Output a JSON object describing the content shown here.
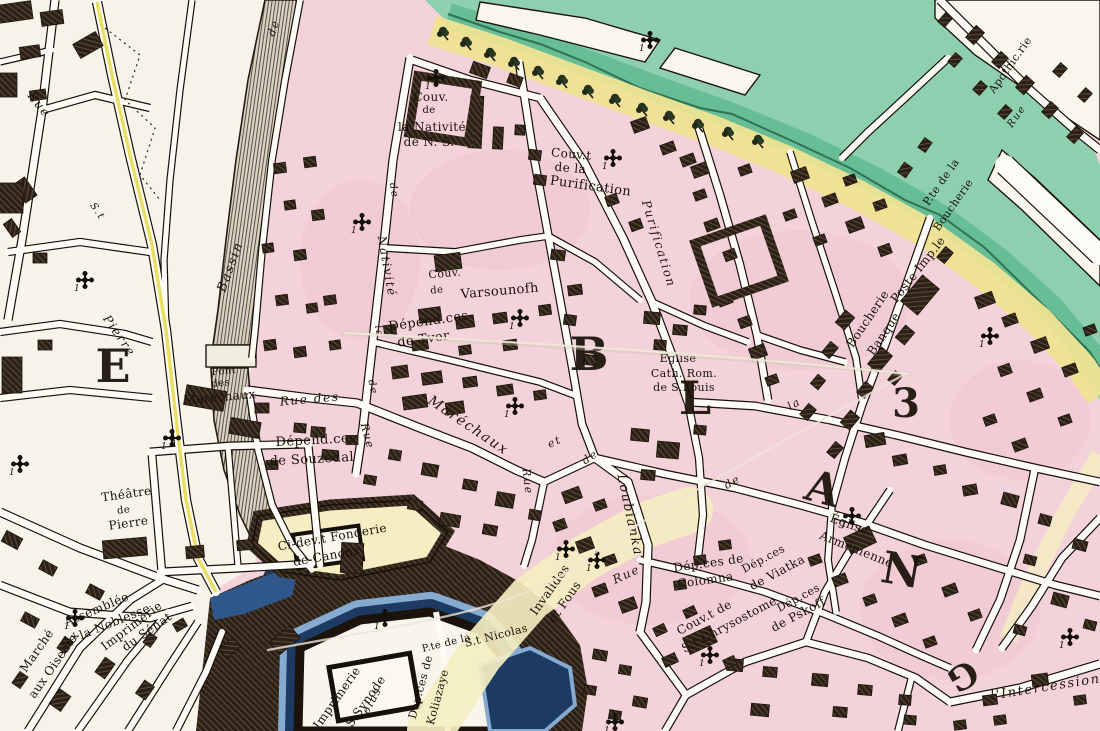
{
  "map": {
    "type": "engraved-city-plan",
    "palette": {
      "paper": "#f7f3ea",
      "street_white": "#fdfbf5",
      "block_pink": "#f4d2d9",
      "pink_mottle": "#ecc2cc",
      "river_green": "#8ecfae",
      "river_green_deep": "#66bd96",
      "river_line": "#2e7354",
      "bank_yellow": "#eee394",
      "pale_yellow": "#f4eec2",
      "road_yellow": "#e9de63",
      "building_dark": "#2c2117",
      "hatch_light": "#5d4d3a",
      "channel_gray": "#ddd6c8",
      "moat_navy": "#1d3a63",
      "moat_blue": "#3a6aa0",
      "moat_light": "#86abd1",
      "ink": "#17100a"
    },
    "icons": {
      "church_cross": "cross-pattee church marker",
      "tree": "riverbank tree glyph",
      "cross_numeral": "1"
    },
    "labels": [
      {
        "t": "Couv.",
        "x": 431,
        "y": 101,
        "r": 0,
        "s": 12,
        "k": "place"
      },
      {
        "t": "de",
        "x": 429,
        "y": 113,
        "r": 0,
        "s": 10,
        "k": "place"
      },
      {
        "t": "la Nativité",
        "x": 432,
        "y": 131,
        "r": 0,
        "s": 12,
        "k": "place"
      },
      {
        "t": "de N. S.",
        "x": 429,
        "y": 146,
        "r": 0,
        "s": 12,
        "k": "place"
      },
      {
        "t": "Couv.t",
        "x": 571,
        "y": 158,
        "r": 5,
        "s": 12,
        "k": "place"
      },
      {
        "t": "de la",
        "x": 570,
        "y": 172,
        "r": 5,
        "s": 12,
        "k": "place"
      },
      {
        "t": "Purification",
        "x": 590,
        "y": 190,
        "r": 8,
        "s": 13,
        "k": "place"
      },
      {
        "t": "Couv.",
        "x": 445,
        "y": 277,
        "r": -5,
        "s": 11,
        "k": "place"
      },
      {
        "t": "de",
        "x": 437,
        "y": 293,
        "r": -5,
        "s": 10,
        "k": "place"
      },
      {
        "t": "Varsounofh",
        "x": 500,
        "y": 295,
        "r": -5,
        "s": 13,
        "k": "place"
      },
      {
        "t": "Dépend.ces",
        "x": 429,
        "y": 325,
        "r": -8,
        "s": 13,
        "k": "place"
      },
      {
        "t": "de Tver",
        "x": 424,
        "y": 343,
        "r": -8,
        "s": 13,
        "k": "place"
      },
      {
        "t": "Rue des",
        "x": 310,
        "y": 403,
        "r": -5,
        "s": 12,
        "k": "street"
      },
      {
        "t": "Dépend.ces",
        "x": 316,
        "y": 444,
        "r": -3,
        "s": 13,
        "k": "place"
      },
      {
        "t": "de Souzedal",
        "x": 312,
        "y": 463,
        "r": -3,
        "s": 13,
        "k": "place"
      },
      {
        "t": "Pont",
        "x": 224,
        "y": 374,
        "r": -5,
        "s": 10,
        "k": "place"
      },
      {
        "t": "des",
        "x": 221,
        "y": 386,
        "r": -5,
        "s": 10,
        "k": "place"
      },
      {
        "t": "Maréchaux",
        "x": 220,
        "y": 401,
        "r": -5,
        "s": 12,
        "k": "place"
      },
      {
        "t": "Théâtre",
        "x": 127,
        "y": 498,
        "r": -8,
        "s": 12,
        "k": "place"
      },
      {
        "t": "de",
        "x": 124,
        "y": 513,
        "r": -8,
        "s": 10,
        "k": "place"
      },
      {
        "t": "Pierre",
        "x": 129,
        "y": 527,
        "r": -8,
        "s": 12,
        "k": "place"
      },
      {
        "t": "Assemblée",
        "x": 98,
        "y": 613,
        "r": -23,
        "s": 12,
        "k": "place"
      },
      {
        "t": "de la Noblesse",
        "x": 107,
        "y": 629,
        "r": -22,
        "s": 12,
        "k": "place"
      },
      {
        "t": "Imprimerie",
        "x": 134,
        "y": 629,
        "r": -37,
        "s": 12,
        "k": "place"
      },
      {
        "t": "du Sénat",
        "x": 149,
        "y": 635,
        "r": -35,
        "s": 12,
        "k": "place"
      },
      {
        "t": "Marché",
        "x": 40,
        "y": 653,
        "r": -55,
        "s": 12,
        "k": "place"
      },
      {
        "t": "aux Oiseaux",
        "x": 57,
        "y": 667,
        "r": -55,
        "s": 12,
        "k": "place"
      },
      {
        "t": "Ci-dev.t Fonderie",
        "x": 333,
        "y": 541,
        "r": -10,
        "s": 12,
        "k": "place"
      },
      {
        "t": "de Canons",
        "x": 327,
        "y": 560,
        "r": -10,
        "s": 12,
        "k": "place"
      },
      {
        "t": "Invalides",
        "x": 553,
        "y": 592,
        "r": -55,
        "s": 12,
        "k": "place"
      },
      {
        "t": "et Fous",
        "x": 568,
        "y": 604,
        "r": -55,
        "s": 12,
        "k": "place"
      },
      {
        "t": "Église",
        "x": 678,
        "y": 362,
        "r": 0,
        "s": 11,
        "k": "place"
      },
      {
        "t": "Cath. Rom.",
        "x": 684,
        "y": 377,
        "r": 0,
        "s": 11,
        "k": "place"
      },
      {
        "t": "de S.Louis",
        "x": 684,
        "y": 391,
        "r": 0,
        "s": 11,
        "k": "place"
      },
      {
        "t": "Église",
        "x": 848,
        "y": 528,
        "r": 20,
        "s": 12,
        "k": "place"
      },
      {
        "t": "Arménienne",
        "x": 855,
        "y": 553,
        "r": 22,
        "s": 12,
        "k": "place"
      },
      {
        "t": "Dép.ces de",
        "x": 709,
        "y": 567,
        "r": -8,
        "s": 12,
        "k": "place"
      },
      {
        "t": "Colomna",
        "x": 706,
        "y": 584,
        "r": -8,
        "s": 12,
        "k": "place"
      },
      {
        "t": "Dép.ces",
        "x": 765,
        "y": 562,
        "r": -28,
        "s": 11,
        "k": "place"
      },
      {
        "t": "de Viatka",
        "x": 779,
        "y": 576,
        "r": -28,
        "s": 12,
        "k": "place"
      },
      {
        "t": "Couv.t de",
        "x": 706,
        "y": 621,
        "r": -28,
        "s": 12,
        "k": "place"
      },
      {
        "t": "S.t Chrysostome",
        "x": 731,
        "y": 628,
        "r": -28,
        "s": 12,
        "k": "place"
      },
      {
        "t": "Dép.ces",
        "x": 800,
        "y": 601,
        "r": -28,
        "s": 11,
        "k": "place"
      },
      {
        "t": "de Pskoff",
        "x": 800,
        "y": 618,
        "r": -28,
        "s": 12,
        "k": "place"
      },
      {
        "t": "Boucherie",
        "x": 871,
        "y": 321,
        "r": -56,
        "s": 12,
        "k": "place"
      },
      {
        "t": "Banque",
        "x": 887,
        "y": 336,
        "r": -56,
        "s": 12,
        "k": "place"
      },
      {
        "t": "Poste Imp.le",
        "x": 921,
        "y": 272,
        "r": -52,
        "s": 12,
        "k": "place"
      },
      {
        "t": "P.te de la",
        "x": 944,
        "y": 184,
        "r": -55,
        "s": 11,
        "k": "place"
      },
      {
        "t": "Boucherie",
        "x": 956,
        "y": 207,
        "r": -55,
        "s": 11,
        "k": "place"
      },
      {
        "t": "Apothic.rie",
        "x": 1013,
        "y": 67,
        "r": -55,
        "s": 11,
        "k": "place"
      },
      {
        "t": "Rue",
        "x": 1019,
        "y": 118,
        "r": -55,
        "s": 10,
        "k": "street"
      },
      {
        "t": "Imprimerie",
        "x": 340,
        "y": 700,
        "r": -55,
        "s": 12,
        "k": "place"
      },
      {
        "t": "du S.Synode",
        "x": 363,
        "y": 712,
        "r": -55,
        "s": 12,
        "k": "place"
      },
      {
        "t": "Dep.ces de",
        "x": 424,
        "y": 688,
        "r": -75,
        "s": 11,
        "k": "place"
      },
      {
        "t": "Koliazaye",
        "x": 441,
        "y": 698,
        "r": -75,
        "s": 11,
        "k": "place"
      },
      {
        "t": "P.te de la",
        "x": 447,
        "y": 646,
        "r": -14,
        "s": 10,
        "k": "place"
      },
      {
        "t": "S.t Nicolas",
        "x": 497,
        "y": 639,
        "r": -14,
        "s": 11,
        "k": "place"
      },
      {
        "t": "olas",
        "x": 375,
        "y": 702,
        "r": -62,
        "s": 11,
        "k": "street"
      },
      {
        "t": "l'Intercession",
        "x": 1046,
        "y": 691,
        "r": -9,
        "s": 13,
        "k": "street"
      },
      {
        "t": "Rue",
        "x": 36,
        "y": 107,
        "r": 52,
        "s": 12,
        "k": "street"
      },
      {
        "t": "S.t",
        "x": 95,
        "y": 213,
        "r": 55,
        "s": 10,
        "k": "street"
      },
      {
        "t": "Pierre",
        "x": 116,
        "y": 338,
        "r": 55,
        "s": 12,
        "k": "street"
      },
      {
        "t": "de",
        "x": 277,
        "y": 29,
        "r": -72,
        "s": 11,
        "k": "street"
      },
      {
        "t": "Bassin",
        "x": 234,
        "y": 268,
        "r": -70,
        "s": 13,
        "k": "street"
      },
      {
        "t": "Rue",
        "x": 364,
        "y": 437,
        "r": 75,
        "s": 11,
        "k": "street"
      },
      {
        "t": "de",
        "x": 370,
        "y": 388,
        "r": 77,
        "s": 10,
        "k": "street"
      },
      {
        "t": "la",
        "x": 376,
        "y": 332,
        "r": 78,
        "s": 10,
        "k": "street"
      },
      {
        "t": "Nativité",
        "x": 383,
        "y": 267,
        "r": 80,
        "s": 12,
        "k": "street"
      },
      {
        "t": "de",
        "x": 391,
        "y": 191,
        "r": 80,
        "s": 10,
        "k": "street"
      },
      {
        "t": "Purification",
        "x": 655,
        "y": 245,
        "r": 73,
        "s": 12,
        "k": "street"
      },
      {
        "t": "et",
        "x": 556,
        "y": 445,
        "r": -25,
        "s": 11,
        "k": "street"
      },
      {
        "t": "de",
        "x": 592,
        "y": 460,
        "r": -35,
        "s": 11,
        "k": "street"
      },
      {
        "t": "Loubianka",
        "x": 626,
        "y": 516,
        "r": 78,
        "s": 13,
        "k": "street"
      },
      {
        "t": "Rue",
        "x": 628,
        "y": 578,
        "r": -25,
        "s": 12,
        "k": "street"
      },
      {
        "t": "Rue",
        "x": 524,
        "y": 482,
        "r": 83,
        "s": 11,
        "k": "street"
      },
      {
        "t": "de",
        "x": 734,
        "y": 485,
        "r": -30,
        "s": 11,
        "k": "street"
      },
      {
        "t": "la",
        "x": 796,
        "y": 407,
        "r": -30,
        "s": 11,
        "k": "street"
      },
      {
        "t": "Maréchaux",
        "x": 466,
        "y": 429,
        "r": 34,
        "s": 14,
        "k": "street"
      }
    ],
    "district_letters": [
      {
        "ch": "E",
        "x": 113,
        "y": 382,
        "s": 46,
        "r": 0
      },
      {
        "ch": "B",
        "x": 589,
        "y": 370,
        "s": 46,
        "r": 0
      },
      {
        "ch": "L",
        "x": 695,
        "y": 414,
        "s": 46,
        "r": 0
      },
      {
        "ch": "A",
        "x": 819,
        "y": 503,
        "s": 44,
        "r": 15
      },
      {
        "ch": "N",
        "x": 899,
        "y": 585,
        "s": 44,
        "r": 10
      },
      {
        "ch": "3",
        "x": 906,
        "y": 417,
        "s": 40,
        "r": 0
      },
      {
        "ch": "G",
        "x": 957,
        "y": 666,
        "s": 34,
        "r": 150
      }
    ],
    "church_crosses": [
      {
        "x": 436,
        "y": 78
      },
      {
        "x": 613,
        "y": 158
      },
      {
        "x": 650,
        "y": 40
      },
      {
        "x": 520,
        "y": 318
      },
      {
        "x": 362,
        "y": 222
      },
      {
        "x": 515,
        "y": 406
      },
      {
        "x": 172,
        "y": 438
      },
      {
        "x": 85,
        "y": 280
      },
      {
        "x": 20,
        "y": 464
      },
      {
        "x": 75,
        "y": 618
      },
      {
        "x": 385,
        "y": 618
      },
      {
        "x": 852,
        "y": 516
      },
      {
        "x": 990,
        "y": 336
      },
      {
        "x": 1070,
        "y": 637
      },
      {
        "x": 710,
        "y": 655
      },
      {
        "x": 615,
        "y": 722
      },
      {
        "x": 566,
        "y": 549
      },
      {
        "x": 597,
        "y": 560
      }
    ]
  }
}
